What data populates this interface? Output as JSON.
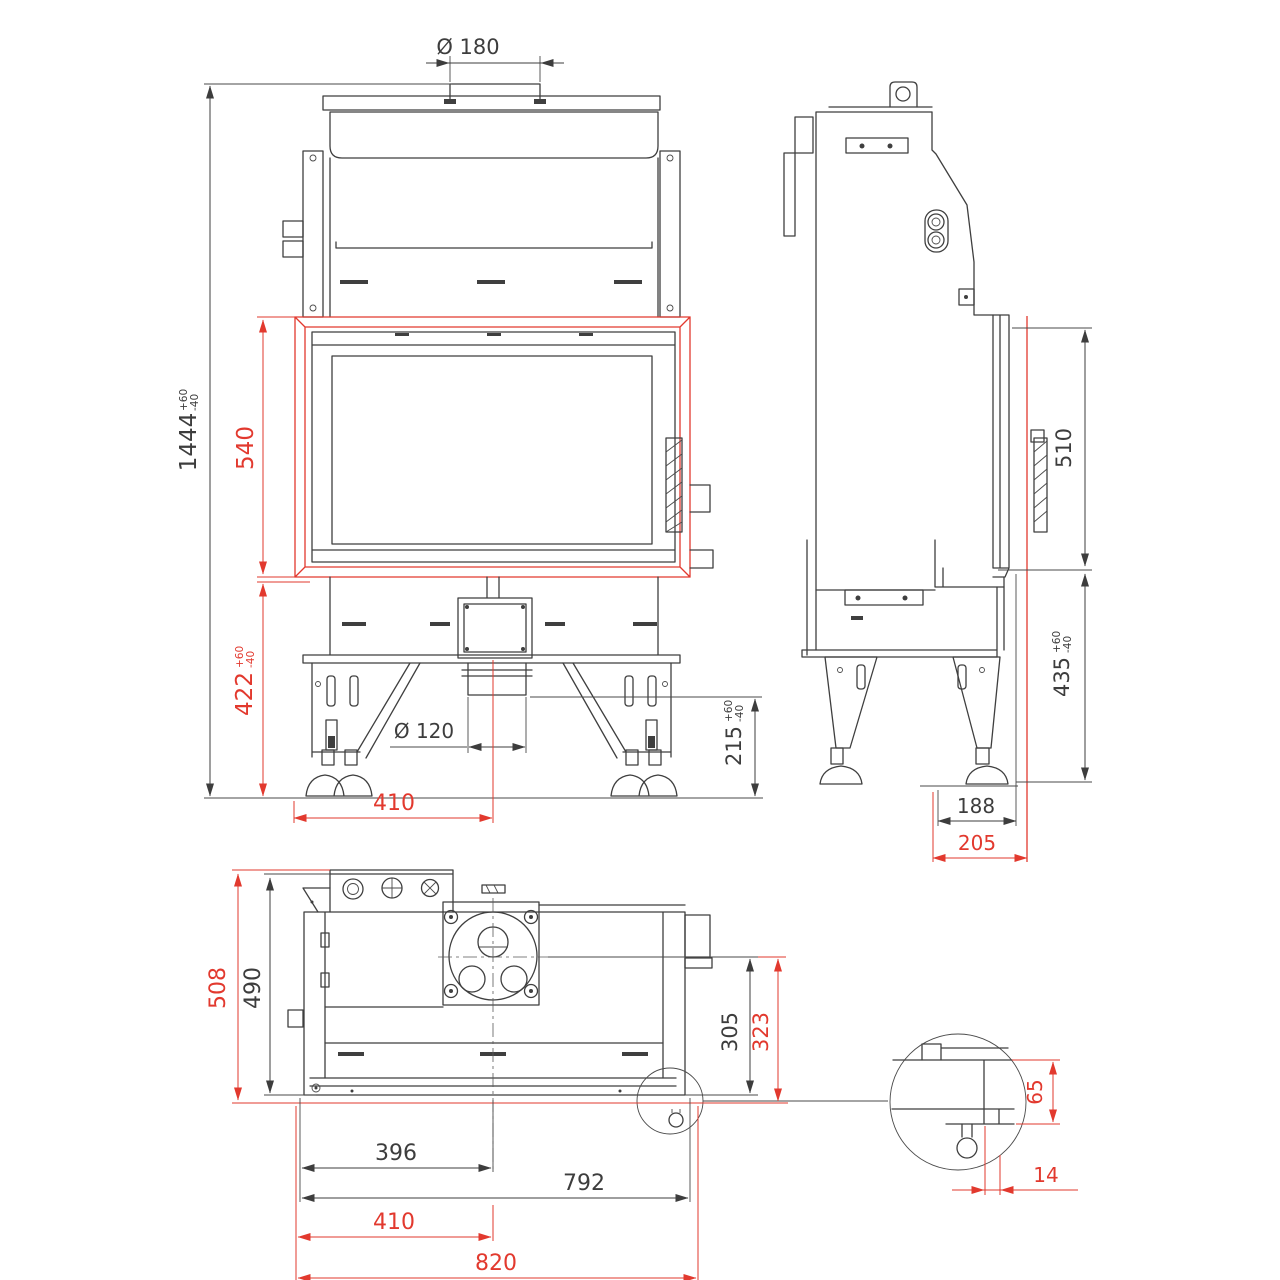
{
  "drawing": {
    "background_color": "#ffffff",
    "line_color": "#3f3f3f",
    "dimension_color": "#3d3d3d",
    "highlight_color": "#e2392e"
  },
  "dimensions": {
    "overall_height": {
      "value": "1444",
      "tol_plus": "+60",
      "tol_minus": "-40"
    },
    "flue_diameter": {
      "value": "Ø 180"
    },
    "door_height": {
      "value": "540"
    },
    "plinth_height": {
      "value": "422",
      "tol_plus": "+60",
      "tol_minus": "-40"
    },
    "inlet_diameter": {
      "value": "Ø 120"
    },
    "inlet_height": {
      "value": "215",
      "tol_plus": "+60",
      "tol_minus": "-40"
    },
    "inlet_axis_offset": {
      "value": "410"
    },
    "side_glass_height": {
      "value": "510"
    },
    "side_plinth_height": {
      "value": "435",
      "tol_plus": "+60",
      "tol_minus": "-40"
    },
    "side_base_depth": {
      "value": "188"
    },
    "side_overall_depth": {
      "value": "205"
    },
    "plan_overall_depth": {
      "value": "508"
    },
    "plan_body_depth": {
      "value": "490"
    },
    "plan_axis_to_front": {
      "value": "305"
    },
    "plan_axis_to_front_outer": {
      "value": "323"
    },
    "plan_half_width": {
      "value": "396"
    },
    "plan_body_width": {
      "value": "792"
    },
    "plan_axis_offset": {
      "value": "410"
    },
    "plan_overall_width": {
      "value": "820"
    },
    "detail_height": {
      "value": "65"
    },
    "detail_offset": {
      "value": "14"
    }
  }
}
